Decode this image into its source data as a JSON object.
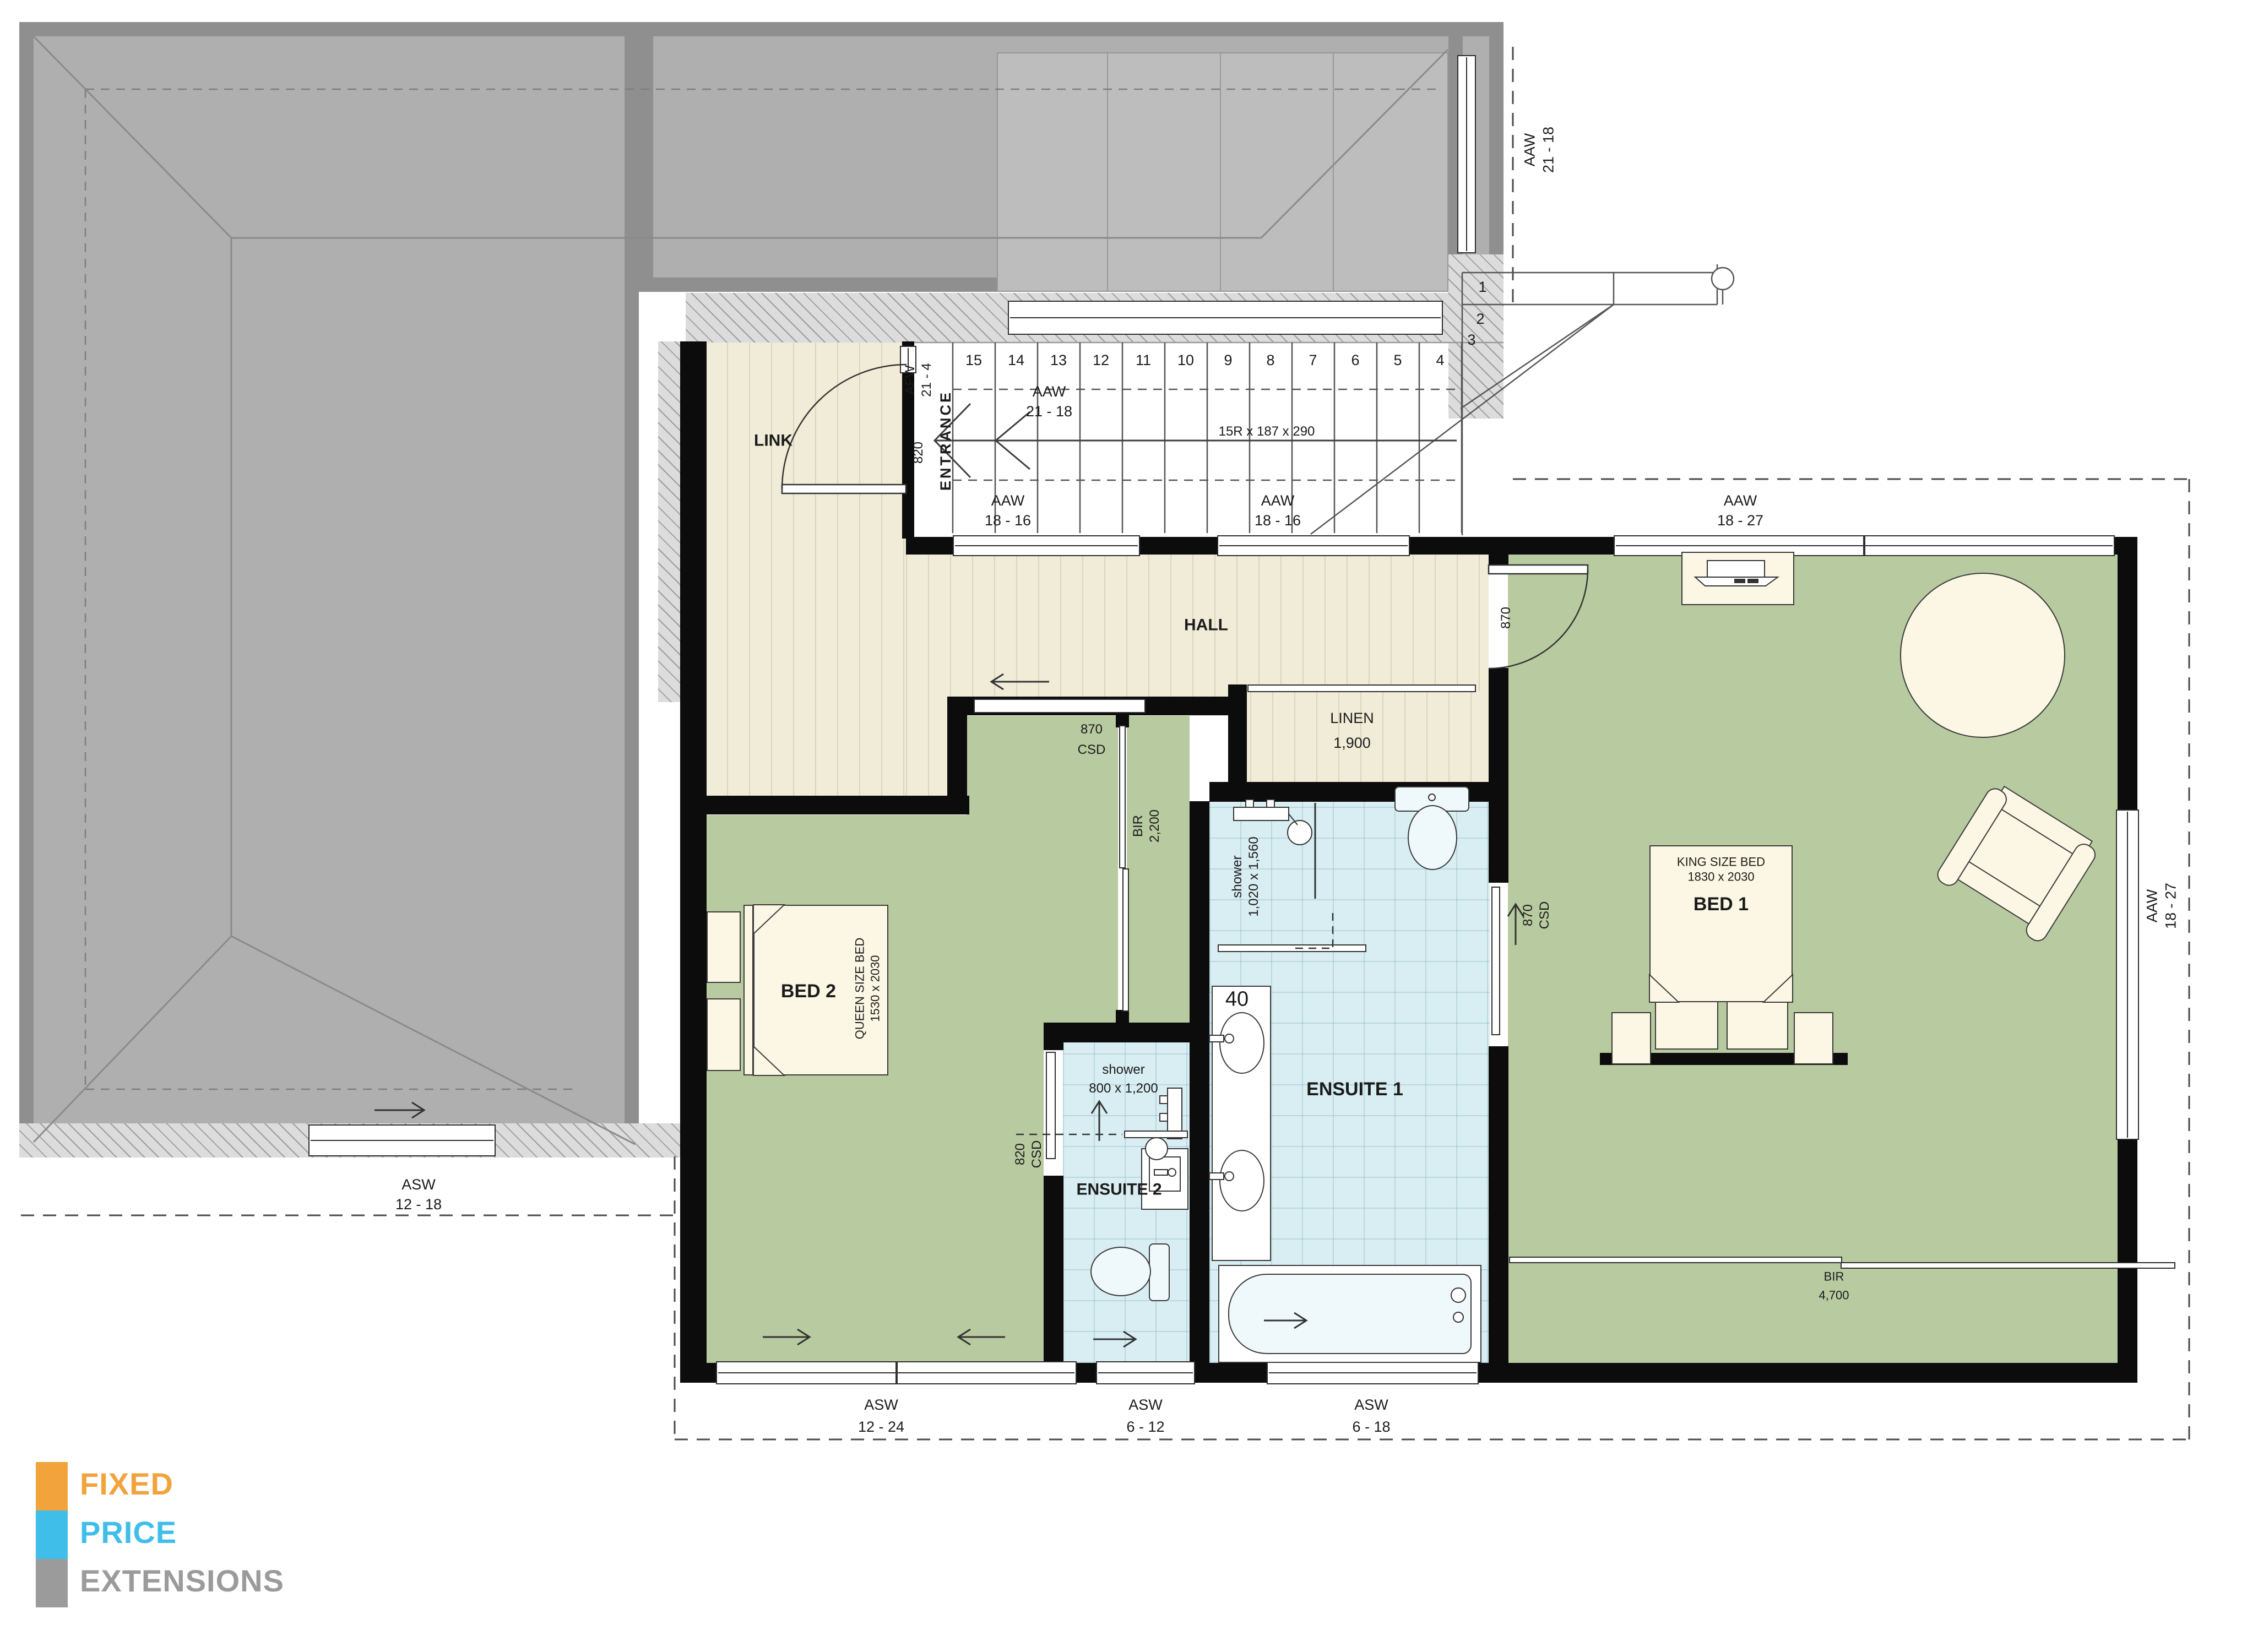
{
  "logo": {
    "line1": "FIXED",
    "line2": "PRICE",
    "line3": "EXTENSIONS",
    "colors": {
      "orange": "#F2A33B",
      "blue": "#3FBEE9",
      "gray": "#9B9B9B"
    }
  },
  "rooms": {
    "link": {
      "name": "LINK"
    },
    "entrance": {
      "name": "ENTRANCE"
    },
    "hall": {
      "name": "HALL"
    },
    "linen": {
      "name": "LINEN",
      "size": "1,900"
    },
    "bed1": {
      "name": "BED 1",
      "bed_type": "KING SIZE BED",
      "bed_size": "1830 x 2030",
      "robe_label": "BIR",
      "robe_size": "4,700"
    },
    "bed2": {
      "name": "BED 2",
      "bed_type": "QUEEN SIZE BED",
      "bed_size": "1530 x 2030",
      "robe_label": "BIR",
      "robe_size": "2,200"
    },
    "ensuite1": {
      "name": "ENSUITE 1",
      "shower_label": "shower",
      "shower_size": "1,020 x 1,560",
      "vanity_width": "40"
    },
    "ensuite2": {
      "name": "ENSUITE 2",
      "shower_label": "shower",
      "shower_size": "800 x 1,200"
    }
  },
  "stairs": {
    "spec": "15R x 187 x 290",
    "run_numbers": [
      "15",
      "14",
      "13",
      "12",
      "11",
      "10",
      "9",
      "8",
      "7",
      "6",
      "5",
      "4"
    ],
    "winders": {
      "n1": "1",
      "n2": "2",
      "n3": "3"
    }
  },
  "doors": {
    "link_door": "820",
    "bed1_door": "870",
    "bed2_door_w": "870",
    "bed2_door_type": "CSD",
    "ensuite1_door_w": "870",
    "ensuite1_door_type": "CSD",
    "ensuite2_door_w": "820",
    "ensuite2_door_type": "CSD"
  },
  "windows": {
    "stair_high": {
      "code": "AAW",
      "size": "21 - 18"
    },
    "entry_fixed": {
      "code": "AFW",
      "size": "21 - 4"
    },
    "hall_a": {
      "code": "AAW",
      "size": "18 - 16"
    },
    "hall_b": {
      "code": "AAW",
      "size": "18 - 16"
    },
    "bed1_top": {
      "code": "AAW",
      "size": "18 - 27"
    },
    "bed1_right": {
      "code": "AAW",
      "size": "18 - 27"
    },
    "existing": {
      "code": "ASW",
      "size": "12 - 18"
    },
    "bed2_bottom": {
      "code": "ASW",
      "size": "12 - 24"
    },
    "ensuite2_bottom": {
      "code": "ASW",
      "size": "6 - 12"
    },
    "ensuite1_bottom": {
      "code": "ASW",
      "size": "6 - 18"
    }
  }
}
